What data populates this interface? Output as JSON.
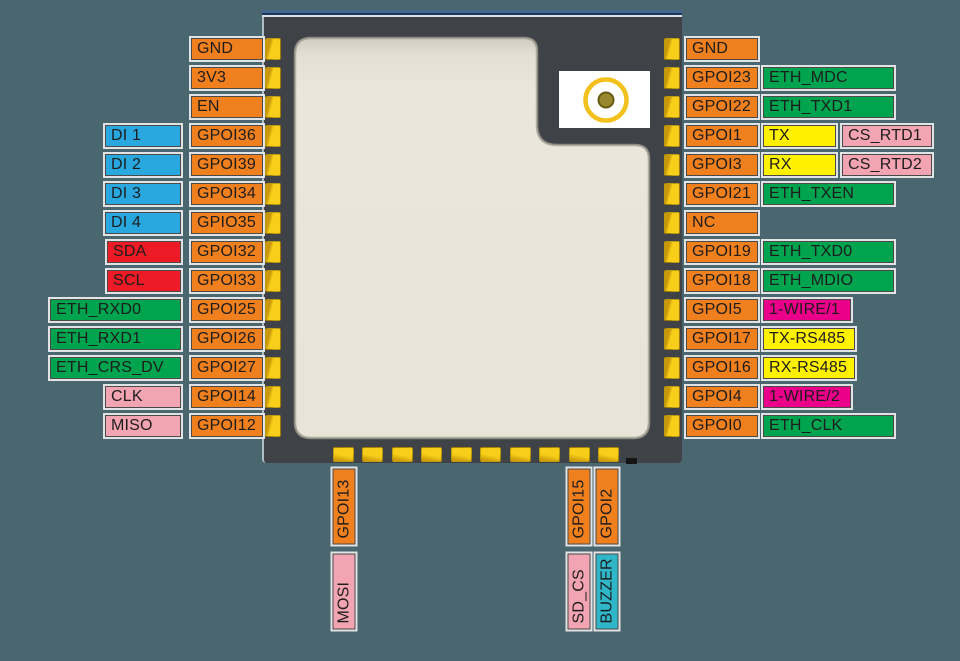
{
  "page": {
    "background": "#4A666F"
  },
  "chip": {
    "body_color": "#3F4347",
    "shield_color": "#EAE6DB",
    "pad_color": "#F2C200",
    "top_line_color": "#44678A",
    "antenna": {
      "ring_color": "#F2C11E",
      "dot_color": "#98872D"
    }
  },
  "type_colors": {
    "pin": "#F07F1E",
    "di": "#29A8E0",
    "i2c": "#EC1B25",
    "eth": "#00A44F",
    "spi": "#F2A4B2",
    "uart": "#FFF100",
    "rtd": "#F2A4B2",
    "wire": "#EA0089",
    "rs485": "#FFF100",
    "buzzer": "#2FB6C9"
  },
  "left_rows": [
    {
      "pin": "GND",
      "signal": null
    },
    {
      "pin": "3V3",
      "signal": null
    },
    {
      "pin": "EN",
      "signal": null
    },
    {
      "pin": "GPOI36",
      "signal": {
        "label": "DI 1",
        "type": "di"
      }
    },
    {
      "pin": "GPOI39",
      "signal": {
        "label": "DI 2",
        "type": "di"
      }
    },
    {
      "pin": "GPOI34",
      "signal": {
        "label": "DI 3",
        "type": "di"
      }
    },
    {
      "pin": "GPIO35",
      "signal": {
        "label": "DI 4",
        "type": "di"
      }
    },
    {
      "pin": "GPOI32",
      "signal": {
        "label": "SDA",
        "type": "i2c"
      }
    },
    {
      "pin": "GPOI33",
      "signal": {
        "label": "SCL",
        "type": "i2c"
      }
    },
    {
      "pin": "GPOI25",
      "signal": {
        "label": "ETH_RXD0",
        "type": "eth"
      }
    },
    {
      "pin": "GPOI26",
      "signal": {
        "label": "ETH_RXD1",
        "type": "eth"
      }
    },
    {
      "pin": "GPOI27",
      "signal": {
        "label": "ETH_CRS_DV",
        "type": "eth"
      }
    },
    {
      "pin": "GPOI14",
      "signal": {
        "label": "CLK",
        "type": "spi"
      }
    },
    {
      "pin": "GPOI12",
      "signal": {
        "label": "MISO",
        "type": "spi"
      }
    }
  ],
  "right_rows": [
    {
      "pin": "GND",
      "signals": []
    },
    {
      "pin": "GPOI23",
      "signals": [
        {
          "label": "ETH_MDC",
          "type": "eth"
        }
      ]
    },
    {
      "pin": "GPOI22",
      "signals": [
        {
          "label": "ETH_TXD1",
          "type": "eth"
        }
      ]
    },
    {
      "pin": "GPOI1",
      "signals": [
        {
          "label": "TX",
          "type": "uart"
        },
        {
          "label": "CS_RTD1",
          "type": "rtd"
        }
      ]
    },
    {
      "pin": "GPOI3",
      "signals": [
        {
          "label": "RX",
          "type": "uart"
        },
        {
          "label": "CS_RTD2",
          "type": "rtd"
        }
      ]
    },
    {
      "pin": "GPOI21",
      "signals": [
        {
          "label": "ETH_TXEN",
          "type": "eth"
        }
      ]
    },
    {
      "pin": "NC",
      "signals": []
    },
    {
      "pin": "GPOI19",
      "signals": [
        {
          "label": "ETH_TXD0",
          "type": "eth"
        }
      ]
    },
    {
      "pin": "GPOI18",
      "signals": [
        {
          "label": "ETH_MDIO",
          "type": "eth"
        }
      ]
    },
    {
      "pin": "GPOI5",
      "signals": [
        {
          "label": "1-WIRE/1",
          "type": "wire"
        }
      ]
    },
    {
      "pin": "GPOI17",
      "signals": [
        {
          "label": "TX-RS485",
          "type": "rs485"
        }
      ]
    },
    {
      "pin": "GPOI16",
      "signals": [
        {
          "label": "RX-RS485",
          "type": "rs485"
        }
      ]
    },
    {
      "pin": "GPOI4",
      "signals": [
        {
          "label": "1-WIRE/2",
          "type": "wire"
        }
      ]
    },
    {
      "pin": "GPOI0",
      "signals": [
        {
          "label": "ETH_CLK",
          "type": "eth"
        }
      ]
    }
  ],
  "bottom_pins": [
    {
      "pin": "GPOI13",
      "signal": {
        "label": "MOSI",
        "type": "spi"
      }
    },
    {
      "pin": "GPOI15",
      "signal": {
        "label": "SD_CS",
        "type": "spi"
      }
    },
    {
      "pin": "GPOI2",
      "signal": {
        "label": "BUZZER",
        "type": "buzzer"
      }
    }
  ]
}
